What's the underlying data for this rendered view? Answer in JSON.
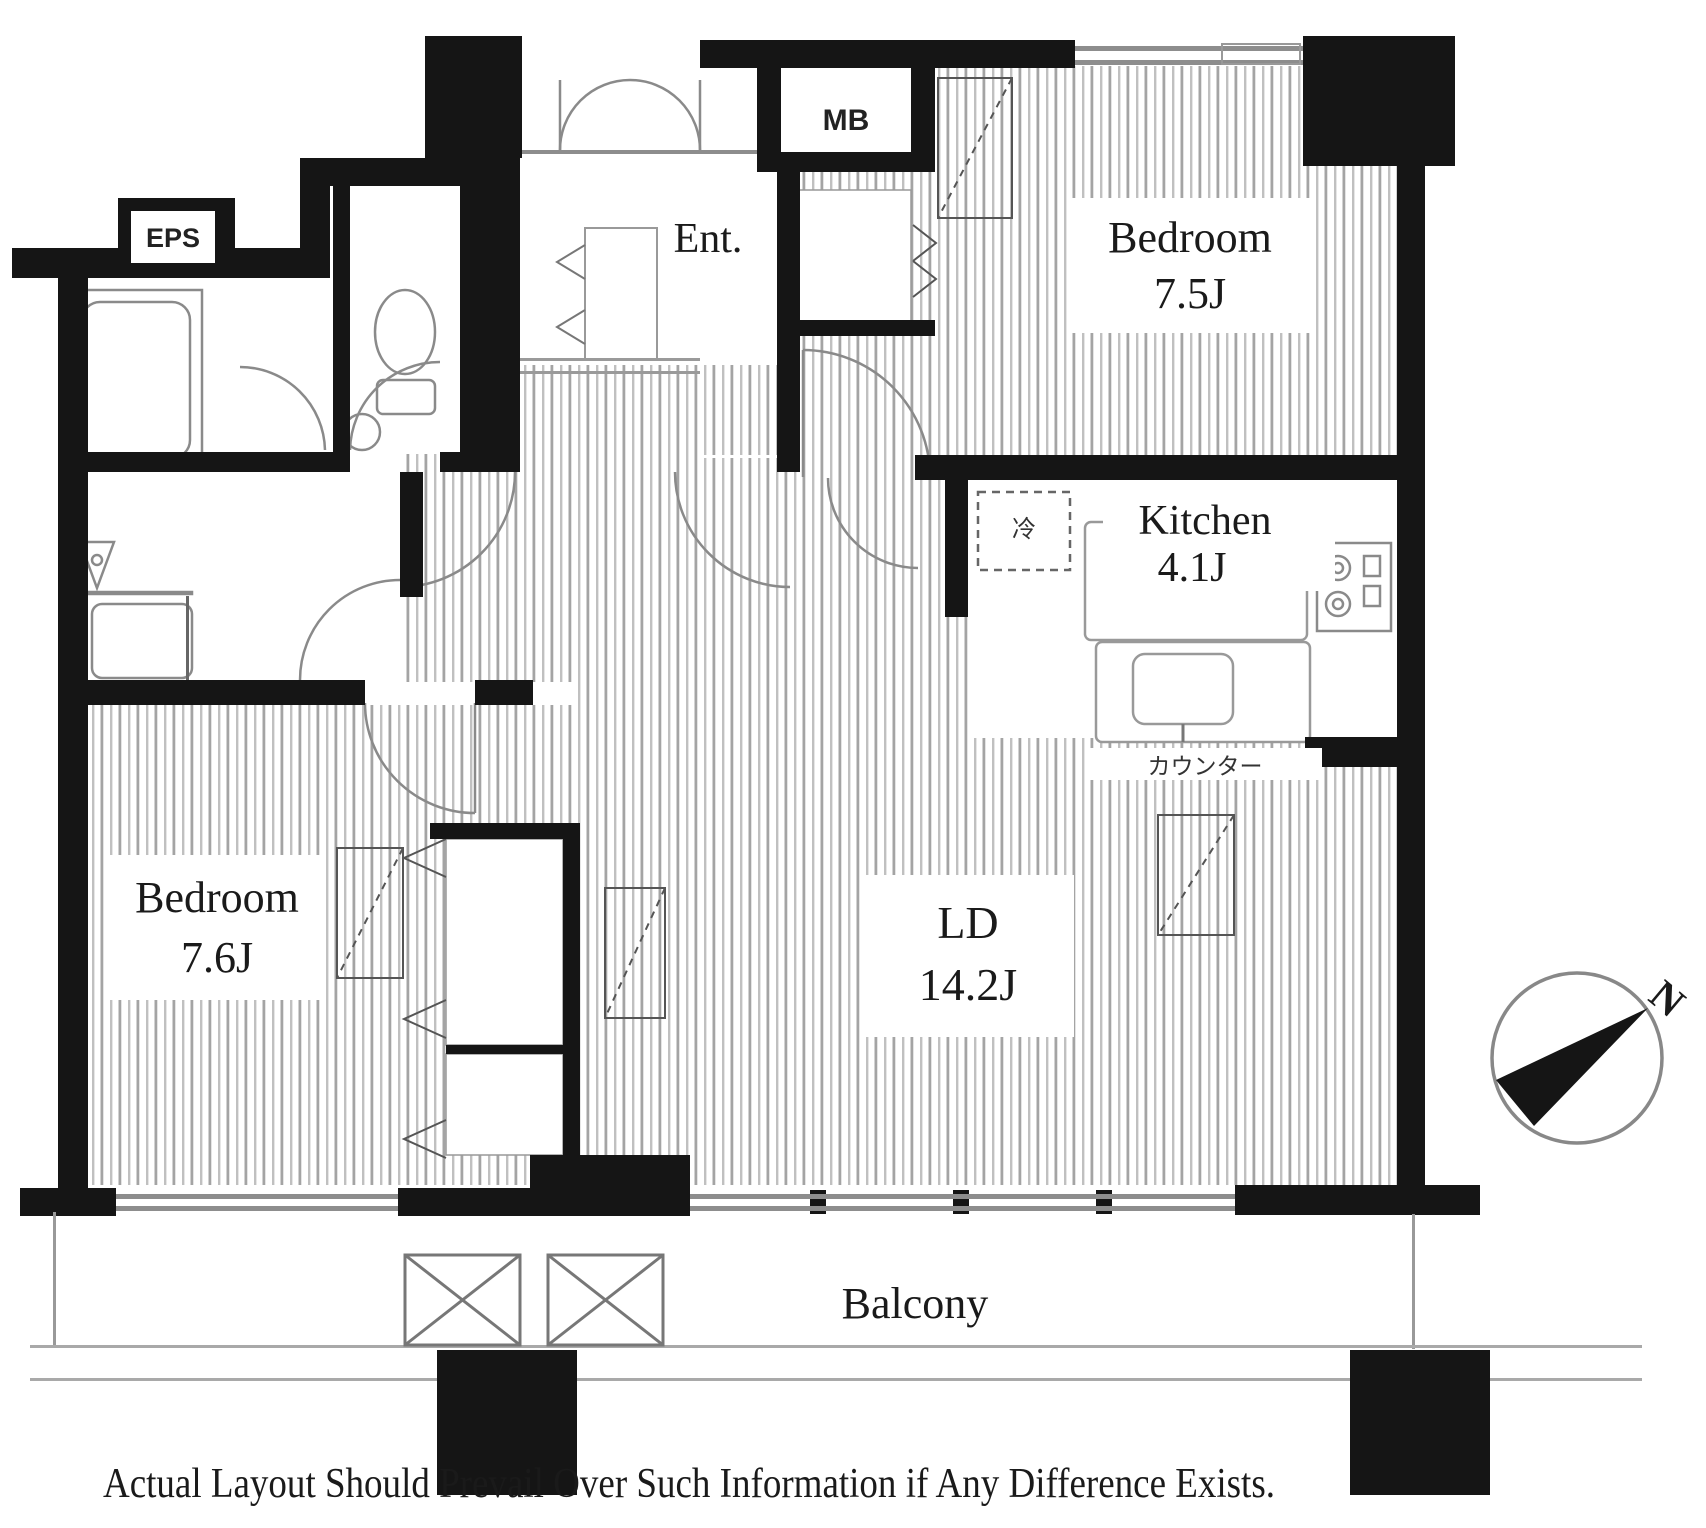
{
  "plan": {
    "rooms": {
      "bedroom_top": {
        "name": "Bedroom",
        "size": "7.5J"
      },
      "bedroom_left": {
        "name": "Bedroom",
        "size": "7.6J"
      },
      "kitchen": {
        "name": "Kitchen",
        "size": "4.1J"
      },
      "living_dining": {
        "name": "LD",
        "size": "14.2J"
      },
      "entrance": {
        "label": "Ent."
      },
      "balcony": {
        "label": "Balcony"
      }
    },
    "annotations": {
      "meter_box": "MB",
      "shaft": "EPS",
      "counter": "カウンター",
      "refrigerator": "冷",
      "compass_north": "N"
    },
    "disclaimer": "Actual Layout Should Prevail Over Such Information if Any Difference Exists."
  },
  "colors": {
    "wall": "#151515",
    "floor_stripe": "#b0b0b0",
    "fixture_line": "#888888",
    "background": "#ffffff"
  }
}
